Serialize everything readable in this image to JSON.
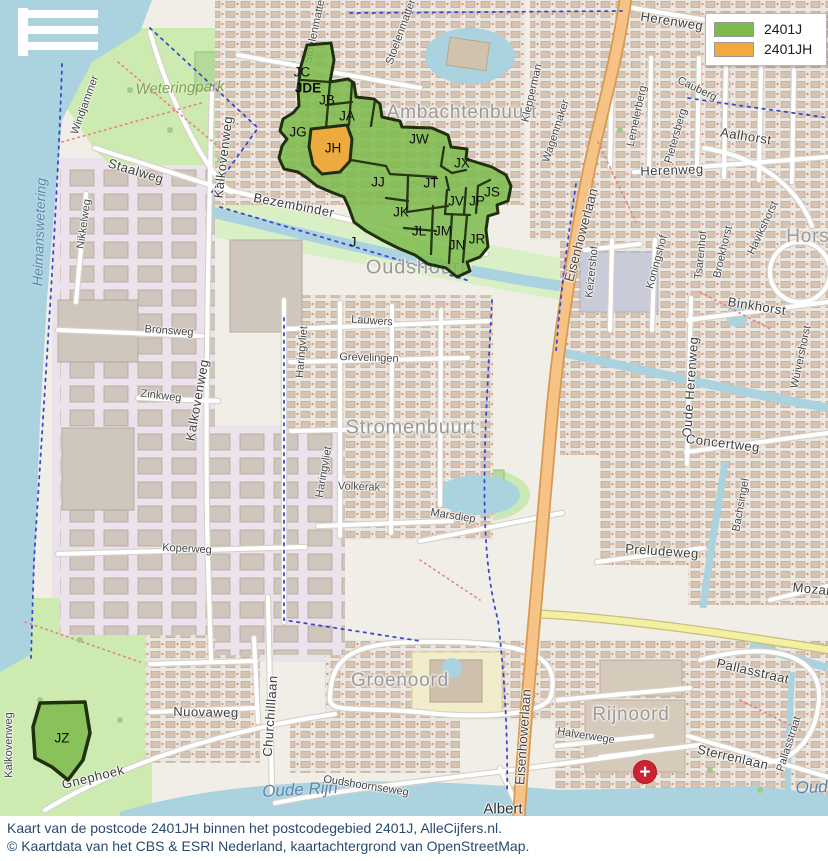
{
  "legend": {
    "items": [
      {
        "label": "2401J",
        "color": "#7cbb4c"
      },
      {
        "label": "2401JH",
        "color": "#f2a93d"
      }
    ]
  },
  "caption": {
    "line1": "Kaart van de postcode 2401JH binnen het postcodegebied 2401J, AlleCijfers.nl.",
    "line2": "© Kaartdata van het CBS & ESRI Nederland, kaartachtergrond van OpenStreetMap."
  },
  "postcode_regions": {
    "area_code": "2401J",
    "highlight_code": "2401JH",
    "colors": {
      "area_fill": "#7cbb4c",
      "highlight_fill": "#f2a93d",
      "border": "#20300f"
    },
    "labels": {
      "jc": "JC",
      "jde": "JDE",
      "jb": "JB",
      "ja": "JA",
      "jg": "JG",
      "jh": "JH",
      "jw": "JW",
      "jx": "JX",
      "jj": "JJ",
      "jt": "JT",
      "jv": "JV",
      "jp": "JP",
      "js": "JS",
      "jk": "JK",
      "jl": "JL",
      "jm": "JM",
      "jn": "JN",
      "jr": "JR",
      "j": "J",
      "jz": "JZ"
    }
  },
  "map_labels": {
    "areas": {
      "ambachtenbuurt": "Ambachtenbuurt",
      "oudshoorn": "Oudshoorn",
      "stromenbuurt": "Stromenbuurt",
      "groenoord": "Groenoord",
      "rijnoord": "Rijnoord",
      "horstenbuurt": "Horstenbuurt"
    },
    "streets": {
      "windjammer": "Windjammer",
      "stoelenmatter": "Stoelenmatter",
      "kalkovenweg": "Kalkovenweg",
      "staalweg": "Staalweg",
      "nikkelweg": "Nikkelweg",
      "bezembinder": "Bezembinder",
      "bronsweg": "Bronsweg",
      "zinkweg": "Zinkweg",
      "koperweg": "Koperweg",
      "lauwers": "Lauwers",
      "grevelingen": "Grevelingen",
      "haringvliet": "Haringvliet",
      "volkerak": "Volkerak",
      "marsdiep": "Marsdiep",
      "herenweg": "Herenweg",
      "klepperman": "Klepperman",
      "wagenmaker": "Wagenmaker",
      "lemelerberg": "Lemelerberg",
      "pietersberg": "Pietersberg",
      "cauberg": "Cauberg",
      "aalhorst": "Aalhorst",
      "havikshorst": "Havikshorst",
      "binkhorst": "Binkhorst",
      "wuivershorst": "Wuivershorst",
      "keizershof": "Keizershof",
      "koningshof": "Koningshof",
      "tsarenhof": "Tsarenhof",
      "broekhorst": "Broekhorst",
      "oude_herenweg": "Oude Herenweg",
      "concertweg": "Concertweg",
      "bachsingel": "Bachsingel",
      "preludeweg": "Preludeweg",
      "mozartsingel": "Mozartsingel",
      "pallasstraat": "Pallasstraat",
      "sterrenlaan": "Sterrenlaan",
      "halverwege": "Halverwege",
      "churchilllaan": "Churchilllaan",
      "nuovaweg": "Nuovaweg",
      "gnephoek": "Gnephoek",
      "oudshoornseweg": "Oudshoornseweg",
      "albert": "Albert",
      "eisenhowerlaan": "Eisenhowerlaan"
    },
    "water": {
      "heimanswetering": "Heimanswetering",
      "oude_rijn": "Oude Rijn"
    },
    "park": {
      "weteringpark": "Weteringpark"
    }
  },
  "icons": {
    "hospital": "+"
  }
}
